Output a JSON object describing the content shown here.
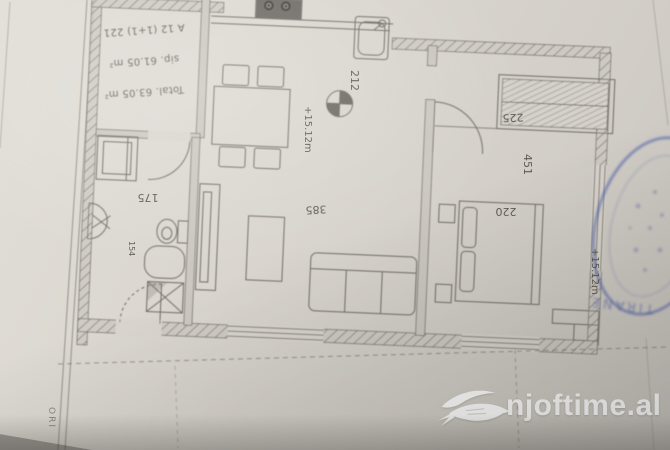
{
  "colors": {
    "paper": "#d8d4cd",
    "ink": "#55514a",
    "stamp_blue": "#4c5da8",
    "watermark_white": "#ffffff"
  },
  "watermark": {
    "brand": "njoftime.al",
    "icon": "swallow-bird"
  },
  "stamp": {
    "text": "TIRANE"
  },
  "paper_edge": {
    "vertical_text": "ORI"
  },
  "plan": {
    "title_block": {
      "line1": "A 12 (1+1) 221",
      "line2": "sip. 61.05 m²",
      "line3": "Total. 63.05 m²"
    },
    "dimensions": {
      "kitchen_width": "212",
      "balcony_width": "225",
      "living_width": "385",
      "bedroom_width": "451",
      "bed_width": "220",
      "bath_width": "175",
      "bath_side": "154"
    },
    "levels": {
      "living": "+15.12m",
      "bedroom": "+15.12m"
    }
  }
}
